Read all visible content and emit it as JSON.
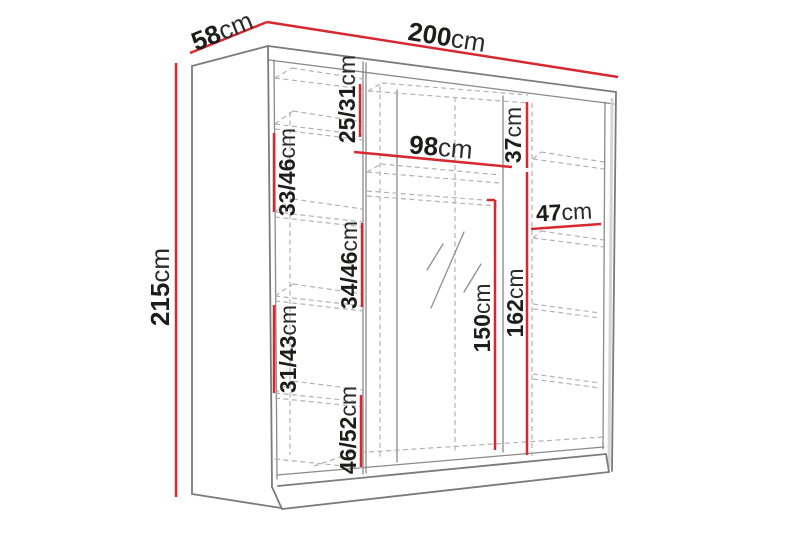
{
  "diagram": {
    "type": "wardrobe-dimension-diagram",
    "colors": {
      "dimension_line": "#d7282f",
      "outline": "#7b7b7b",
      "hidden_line": "#b2b2b2",
      "label_text": "#1d1d1b",
      "background": "#ffffff"
    },
    "labels": {
      "width": {
        "num": "200",
        "unit": "cm"
      },
      "depth": {
        "num": "58",
        "unit": "cm"
      },
      "height": {
        "num": "215",
        "unit": "cm"
      },
      "middle_door_width": {
        "num": "98",
        "unit": "cm"
      },
      "left_shelf_top": {
        "num": "25/31",
        "unit": "cm"
      },
      "left_shelf_2": {
        "num": "33/46",
        "unit": "cm"
      },
      "left_shelf_3": {
        "num": "34/46",
        "unit": "cm"
      },
      "left_shelf_4": {
        "num": "31/43",
        "unit": "cm"
      },
      "left_shelf_bottom": {
        "num": "46/52",
        "unit": "cm"
      },
      "right_top_section": {
        "num": "37",
        "unit": "cm"
      },
      "right_shelf_width": {
        "num": "47",
        "unit": "cm"
      },
      "hanging_height_center": {
        "num": "150",
        "unit": "cm"
      },
      "hanging_height_right": {
        "num": "162",
        "unit": "cm"
      }
    }
  }
}
